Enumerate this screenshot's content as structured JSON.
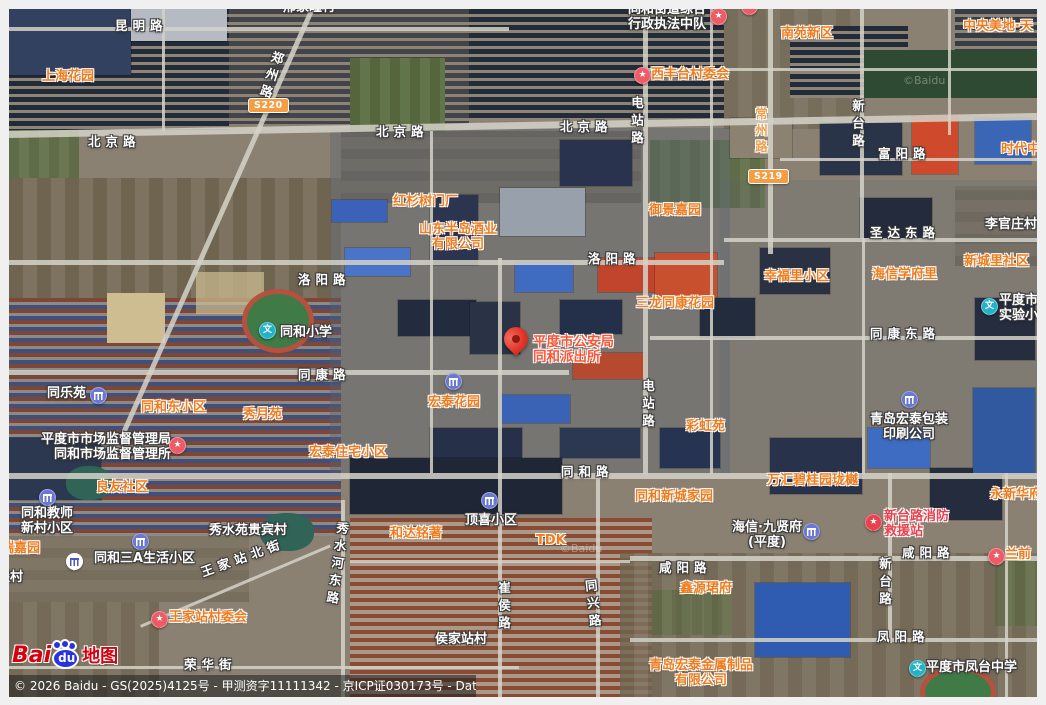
{
  "map": {
    "kind": "satellite",
    "labels": [
      {
        "t": "邢家疃村",
        "x": 283,
        "y": 1,
        "k": "pw"
      },
      {
        "t": "昆明路",
        "x": 115,
        "y": 19,
        "k": "rw"
      },
      {
        "t": "上海花园",
        "x": 42,
        "y": 70,
        "k": "po"
      },
      {
        "t": "郑州路",
        "x": 263,
        "y": 50,
        "k": "rw",
        "v": 1,
        "r": 18
      },
      {
        "t": "北京路",
        "x": 88,
        "y": 135,
        "k": "rw"
      },
      {
        "t": "北京路",
        "x": 376,
        "y": 125,
        "k": "rw"
      },
      {
        "t": "北京路",
        "x": 560,
        "y": 120,
        "k": "rw"
      },
      {
        "t": "同和街道综合\n行政执法中队",
        "x": 628,
        "y": 3,
        "k": "pw",
        "a": "l"
      },
      {
        "t": "西丰台村委会",
        "x": 651,
        "y": 68,
        "k": "po"
      },
      {
        "t": "东丰台里村委会",
        "x": 756,
        "y": -6,
        "k": "po"
      },
      {
        "t": "南苑新区",
        "x": 781,
        "y": 27,
        "k": "po"
      },
      {
        "t": "中央美地·天",
        "x": 963,
        "y": 20,
        "k": "po"
      },
      {
        "t": "电站路",
        "x": 629,
        "y": 96,
        "k": "rw",
        "v": 1
      },
      {
        "t": "常州路",
        "x": 753,
        "y": 107,
        "k": "ro",
        "v": 1
      },
      {
        "t": "新台路",
        "x": 850,
        "y": 99,
        "k": "rw",
        "v": 1
      },
      {
        "t": "富阳路",
        "x": 878,
        "y": 147,
        "k": "rw"
      },
      {
        "t": "时代中",
        "x": 1001,
        "y": 143,
        "k": "po"
      },
      {
        "t": "红杉树门厂",
        "x": 393,
        "y": 195,
        "k": "po"
      },
      {
        "t": "御景嘉园",
        "x": 649,
        "y": 204,
        "k": "po"
      },
      {
        "t": "李官庄村",
        "x": 985,
        "y": 218,
        "k": "pw"
      },
      {
        "t": "山东半岛酒业\n有限公司",
        "x": 419,
        "y": 223,
        "k": "po",
        "a": "c"
      },
      {
        "t": "圣达东路",
        "x": 870,
        "y": 226,
        "k": "rw"
      },
      {
        "t": "洛阳路",
        "x": 298,
        "y": 273,
        "k": "rw"
      },
      {
        "t": "洛阳路",
        "x": 588,
        "y": 252,
        "k": "rw"
      },
      {
        "t": "新城里社区",
        "x": 964,
        "y": 255,
        "k": "po"
      },
      {
        "t": "幸福里小区",
        "x": 764,
        "y": 270,
        "k": "po"
      },
      {
        "t": "海信学府里",
        "x": 872,
        "y": 268,
        "k": "po"
      },
      {
        "t": "三龙同康花园",
        "x": 636,
        "y": 297,
        "k": "po"
      },
      {
        "t": "同和小学",
        "x": 280,
        "y": 326,
        "k": "pw"
      },
      {
        "t": "平度市实\n实验小学",
        "x": 999,
        "y": 294,
        "k": "pw",
        "a": "l"
      },
      {
        "t": "同康东路",
        "x": 870,
        "y": 327,
        "k": "rw"
      },
      {
        "t": "同康路",
        "x": 298,
        "y": 368,
        "k": "rw"
      },
      {
        "t": "平度市公安局\n同和派出所",
        "x": 533,
        "y": 335,
        "k": "pr",
        "a": "l"
      },
      {
        "t": "电站路",
        "x": 640,
        "y": 379,
        "k": "rw",
        "v": 1
      },
      {
        "t": "宏泰花园",
        "x": 428,
        "y": 396,
        "k": "po"
      },
      {
        "t": "彩虹苑",
        "x": 686,
        "y": 420,
        "k": "po"
      },
      {
        "t": "同乐苑",
        "x": 47,
        "y": 387,
        "k": "pw"
      },
      {
        "t": "同和东小区",
        "x": 141,
        "y": 401,
        "k": "po"
      },
      {
        "t": "秀月苑",
        "x": 243,
        "y": 408,
        "k": "po"
      },
      {
        "t": "青岛宏泰包装\n印刷公司",
        "x": 870,
        "y": 413,
        "k": "pw",
        "a": "c"
      },
      {
        "t": "平度市市场监督管理局\n同和市场监督管理所",
        "x": 41,
        "y": 433,
        "k": "pw",
        "a": "r"
      },
      {
        "t": "宏泰住宅小区",
        "x": 309,
        "y": 446,
        "k": "po"
      },
      {
        "t": "同和路",
        "x": 561,
        "y": 465,
        "k": "rw"
      },
      {
        "t": "良友社区",
        "x": 96,
        "y": 481,
        "k": "po"
      },
      {
        "t": "万汇碧桂园珑樾",
        "x": 767,
        "y": 474,
        "k": "po"
      },
      {
        "t": "同和新城家园",
        "x": 635,
        "y": 490,
        "k": "po"
      },
      {
        "t": "永新华府",
        "x": 990,
        "y": 488,
        "k": "po"
      },
      {
        "t": "同和教师\n新村小区",
        "x": 21,
        "y": 507,
        "k": "pw",
        "a": "c"
      },
      {
        "t": "海信·九贤府\n(平度)",
        "x": 732,
        "y": 521,
        "k": "pw",
        "a": "c"
      },
      {
        "t": "新台路消防\n救援站",
        "x": 884,
        "y": 510,
        "k": "pc",
        "a": "l"
      },
      {
        "t": "秀水苑贵宾村",
        "x": 209,
        "y": 524,
        "k": "pw"
      },
      {
        "t": "顶喜小区",
        "x": 465,
        "y": 514,
        "k": "pw"
      },
      {
        "t": "和达铭著",
        "x": 390,
        "y": 527,
        "k": "po"
      },
      {
        "t": "TDK",
        "x": 536,
        "y": 534,
        "k": "po"
      },
      {
        "t": "咸阳路",
        "x": 902,
        "y": 546,
        "k": "rw"
      },
      {
        "t": "兰前",
        "x": 1005,
        "y": 548,
        "k": "po"
      },
      {
        "t": "银瑞嘉园",
        "x": -12,
        "y": 542,
        "k": "po"
      },
      {
        "t": "同和三A生活小区",
        "x": 94,
        "y": 552,
        "k": "pw"
      },
      {
        "t": "咸阳路",
        "x": 659,
        "y": 561,
        "k": "rw"
      },
      {
        "t": "新台路",
        "x": 877,
        "y": 557,
        "k": "rw",
        "v": 1
      },
      {
        "t": "王家站北街",
        "x": 199,
        "y": 551,
        "k": "rw",
        "r": -20
      },
      {
        "t": "里堡村",
        "x": -16,
        "y": 571,
        "k": "pw"
      },
      {
        "t": "鑫源珺府",
        "x": 680,
        "y": 582,
        "k": "po"
      },
      {
        "t": "秀水河东路",
        "x": 329,
        "y": 521,
        "k": "rw",
        "v": 1,
        "r": 8
      },
      {
        "t": "崔侯路",
        "x": 496,
        "y": 581,
        "k": "rw",
        "v": 1
      },
      {
        "t": "同兴路",
        "x": 585,
        "y": 579,
        "k": "rw",
        "v": 1,
        "r": -6
      },
      {
        "t": "王家站村委会",
        "x": 169,
        "y": 611,
        "k": "po"
      },
      {
        "t": "凤阳路",
        "x": 877,
        "y": 630,
        "k": "rw"
      },
      {
        "t": "侯家站村",
        "x": 435,
        "y": 633,
        "k": "pw"
      },
      {
        "t": "荣华街",
        "x": 184,
        "y": 658,
        "k": "rw"
      },
      {
        "t": "青岛宏泰金属制品\n有限公司",
        "x": 649,
        "y": 659,
        "k": "po",
        "a": "c"
      },
      {
        "t": "平度市凤台中学",
        "x": 926,
        "y": 661,
        "k": "pw"
      }
    ],
    "markers": [
      {
        "type": "star",
        "x": 710,
        "y": 8
      },
      {
        "type": "star",
        "x": 634,
        "y": 67
      },
      {
        "type": "star",
        "x": 741,
        "y": -2
      },
      {
        "type": "star",
        "x": 169,
        "y": 437
      },
      {
        "type": "star",
        "x": 151,
        "y": 611
      },
      {
        "type": "star",
        "x": 988,
        "y": 548
      },
      {
        "type": "fire",
        "x": 865,
        "y": 514
      },
      {
        "type": "comm",
        "x": 90,
        "y": 387
      },
      {
        "type": "comm",
        "x": 445,
        "y": 373
      },
      {
        "type": "comm",
        "x": 39,
        "y": 489
      },
      {
        "type": "comm",
        "x": 132,
        "y": 533
      },
      {
        "type": "comm",
        "x": 481,
        "y": 492
      },
      {
        "type": "comm",
        "x": 803,
        "y": 523
      },
      {
        "type": "comm",
        "x": 901,
        "y": 391
      },
      {
        "type": "school",
        "x": 259,
        "y": 322
      },
      {
        "type": "school",
        "x": 981,
        "y": 298
      },
      {
        "type": "school",
        "x": 909,
        "y": 660
      },
      {
        "type": "hotel",
        "x": 66,
        "y": 553
      },
      {
        "type": "pin",
        "x": 504,
        "y": 327
      }
    ],
    "shields": [
      {
        "code": "S220",
        "x": 248,
        "y": 98
      },
      {
        "code": "S219",
        "x": 748,
        "y": 169
      }
    ],
    "watermarks": [
      {
        "t": "©Baidu",
        "x": 903,
        "y": 74
      },
      {
        "t": "©Baidu",
        "x": 560,
        "y": 542
      }
    ],
    "icon_legend": {
      "star": "pink-star-poi-icon",
      "fire": "fire-station-poi-icon",
      "comm": "residential-community-icon",
      "school": "school-wen-icon",
      "hotel": "hotel-white-icon",
      "pin": "red-location-pin-icon"
    },
    "colors": {
      "poi_orange": "#ee7b1d",
      "road_label_white": "#ffffff",
      "police_label_red": "#fb5537",
      "fire_label_crimson": "#e8414e",
      "marker_pink": "#ec5b66",
      "marker_blue": "#6a79cf",
      "marker_teal": "#25b2c6",
      "pin_red": "#e03528",
      "shield_orange": "#f59d42"
    }
  },
  "brand": {
    "bai": "Bai",
    "du": "du",
    "suffix": "地图"
  },
  "attribution": "© 2026 Baidu - GS(2025)4125号 - 甲测资字11111342 - 京ICP证030173号 - Data © 百度智图"
}
